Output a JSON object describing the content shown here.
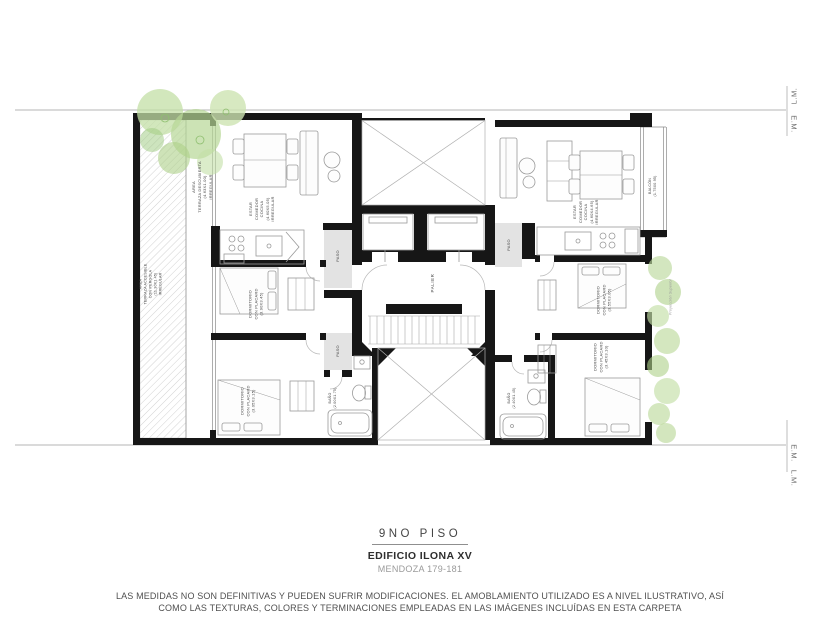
{
  "title_block": {
    "floor": "9NO PISO",
    "building": "EDIFICIO ILONA XV",
    "address": "MENDOZA 179-181"
  },
  "disclaimer": {
    "line1": "LAS MEDIDAS NO SON DEFINITIVAS Y PUEDEN SUFRIR MODIFICACIONES. EL AMOBLAMIENTO UTILIZADO ES A NIVEL ILUSTRATIVO, ASÍ",
    "line2": "COMO LAS TEXTURAS, COLORES Y TERMINACIONES EMPLEADAS EN LAS IMÁGENES INCLUÍDAS EN ESTA CARPETA"
  },
  "boundary_markers": {
    "top_lm": "L.M.",
    "top_em": "E.M.",
    "bottom_em": "E.M.",
    "bottom_lm": "L.M."
  },
  "plan_labels": {
    "terrace_top": "AREA\nTERRAZA DESCUBIERTA\n(4.63X1.00)\nIRREGULAR",
    "terrace_left": "AREA\nTERRAZA ACCESIBLE\nCON PERGOLA\n(11.30X1.45)\nIRREGULAR",
    "left_living": "ESTAR\nCOMEDOR\nCOCINA\n(4.60X5.05)\nIRREGULAR",
    "left_paso_1": "PASO",
    "left_paso_2": "PASO",
    "left_bedroom_1": "DORMITORIO\nCON PLACARD\n(3.90X3.45)",
    "left_bedroom_2": "DORMITORIO\nCON PLACARD\n(3.05X3.15)",
    "left_bath": "BAÑO\n(2.00X1.75)",
    "palier": "PALIER",
    "right_paso": "PASO",
    "right_living": "ESTAR\nCOMEDOR\nCOCINA\n(4.60X4.65)\nIRREGULAR",
    "balcony": "BALCÓN\n(1.75X0.95)",
    "right_bedroom_1": "DORMITORIO\nCON PLACARD\n(3.55X3.05)",
    "right_bedroom_2": "DORMITORIO\nCON PLACARD\n(3.45X3.10)",
    "right_bath": "BAÑO\n(2.40X1.45)",
    "projection_note": "Proyección Superior"
  },
  "colors": {
    "wall": "#161616",
    "paso_fill": "#e3e3e3",
    "furniture_stroke": "#9a9a9a",
    "vegetation": "#b8d798",
    "label_text": "#474747",
    "boundary_line": "#b5b5b5"
  }
}
